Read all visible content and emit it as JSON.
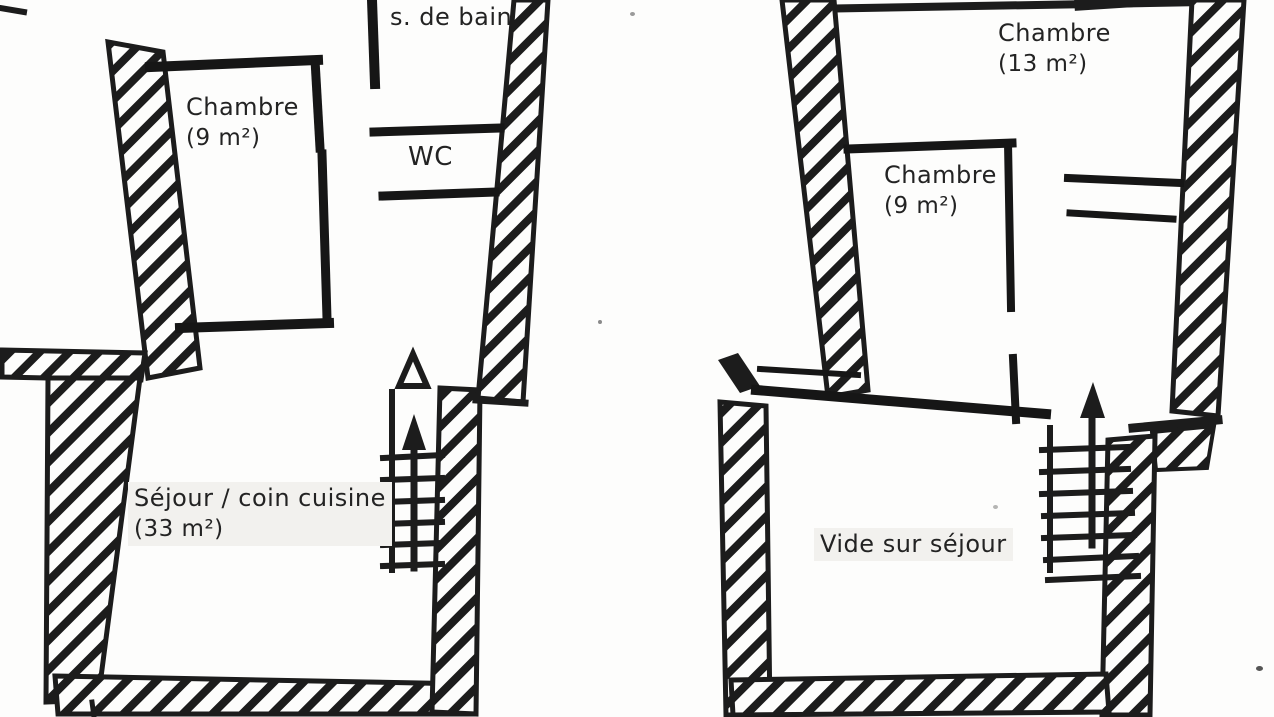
{
  "colors": {
    "ink": "#1c1c1c",
    "paper": "#fdfdfc",
    "label_background": "#f2f1ee"
  },
  "plans": {
    "left": {
      "rooms": [
        {
          "label": "s. de bain",
          "area": ""
        },
        {
          "label": "Chambre",
          "area": "(9 m²)"
        },
        {
          "label": "WC",
          "area": ""
        },
        {
          "label": "Séjour / coin cuisine",
          "area": "(33 m²)"
        }
      ]
    },
    "right": {
      "rooms": [
        {
          "label": "Chambre",
          "area": "(13 m²)"
        },
        {
          "label": "Chambre",
          "area": "(9 m²)"
        },
        {
          "label": "Vide sur séjour",
          "area": ""
        }
      ]
    }
  }
}
